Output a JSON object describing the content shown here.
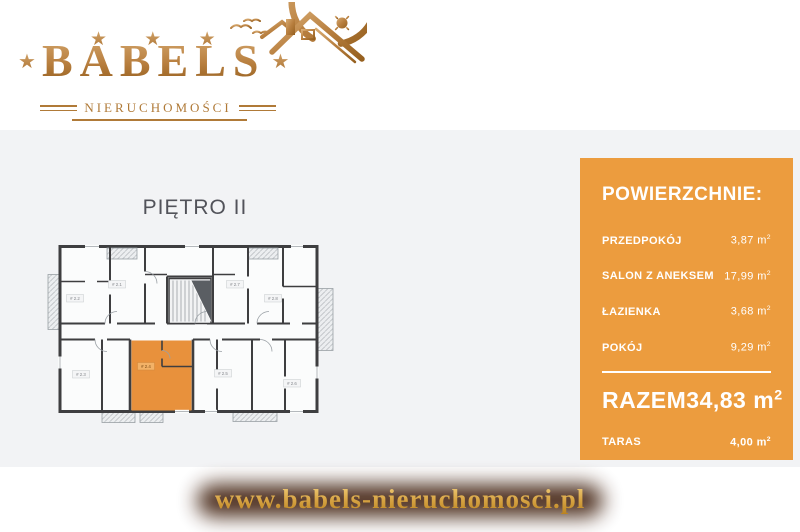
{
  "logo": {
    "brand": "BABELS",
    "subtitle": "NIERUCHOMOŚCI",
    "stars_top": "★ ★ ★",
    "star_left": "★",
    "star_right": "★",
    "gold_dark": "#96601f",
    "gold_light": "#d2a369"
  },
  "floor_plan": {
    "title": "PIĘTRO II",
    "highlight_color": "#E8913C",
    "wall_color": "#3e3e40",
    "room_labels": [
      "# 2.2",
      "# 2.1",
      "# 2.7",
      "# 2.8",
      "# 2.3",
      "# 2.4",
      "# 2.5",
      "# 2.6"
    ]
  },
  "areas_panel": {
    "bg_color": "#EC9C3E",
    "text_color": "#ffffff",
    "title": "POWIERZCHNIE:",
    "unit": "m",
    "unit_sup": "2",
    "rows": [
      {
        "label": "PRZEDPOKÓJ",
        "value": "3,87"
      },
      {
        "label": "SALON Z ANEKSEM",
        "value": "17,99"
      },
      {
        "label": "ŁAZIENKA",
        "value": "3,68"
      },
      {
        "label": "POKÓJ",
        "value": "9,29"
      }
    ],
    "total": {
      "label": "RAZEM",
      "value": "34,83"
    },
    "extra": {
      "label": "TARAS",
      "value": "4,00"
    }
  },
  "footer": {
    "url": "www.babels-nieruchomosci.pl"
  }
}
